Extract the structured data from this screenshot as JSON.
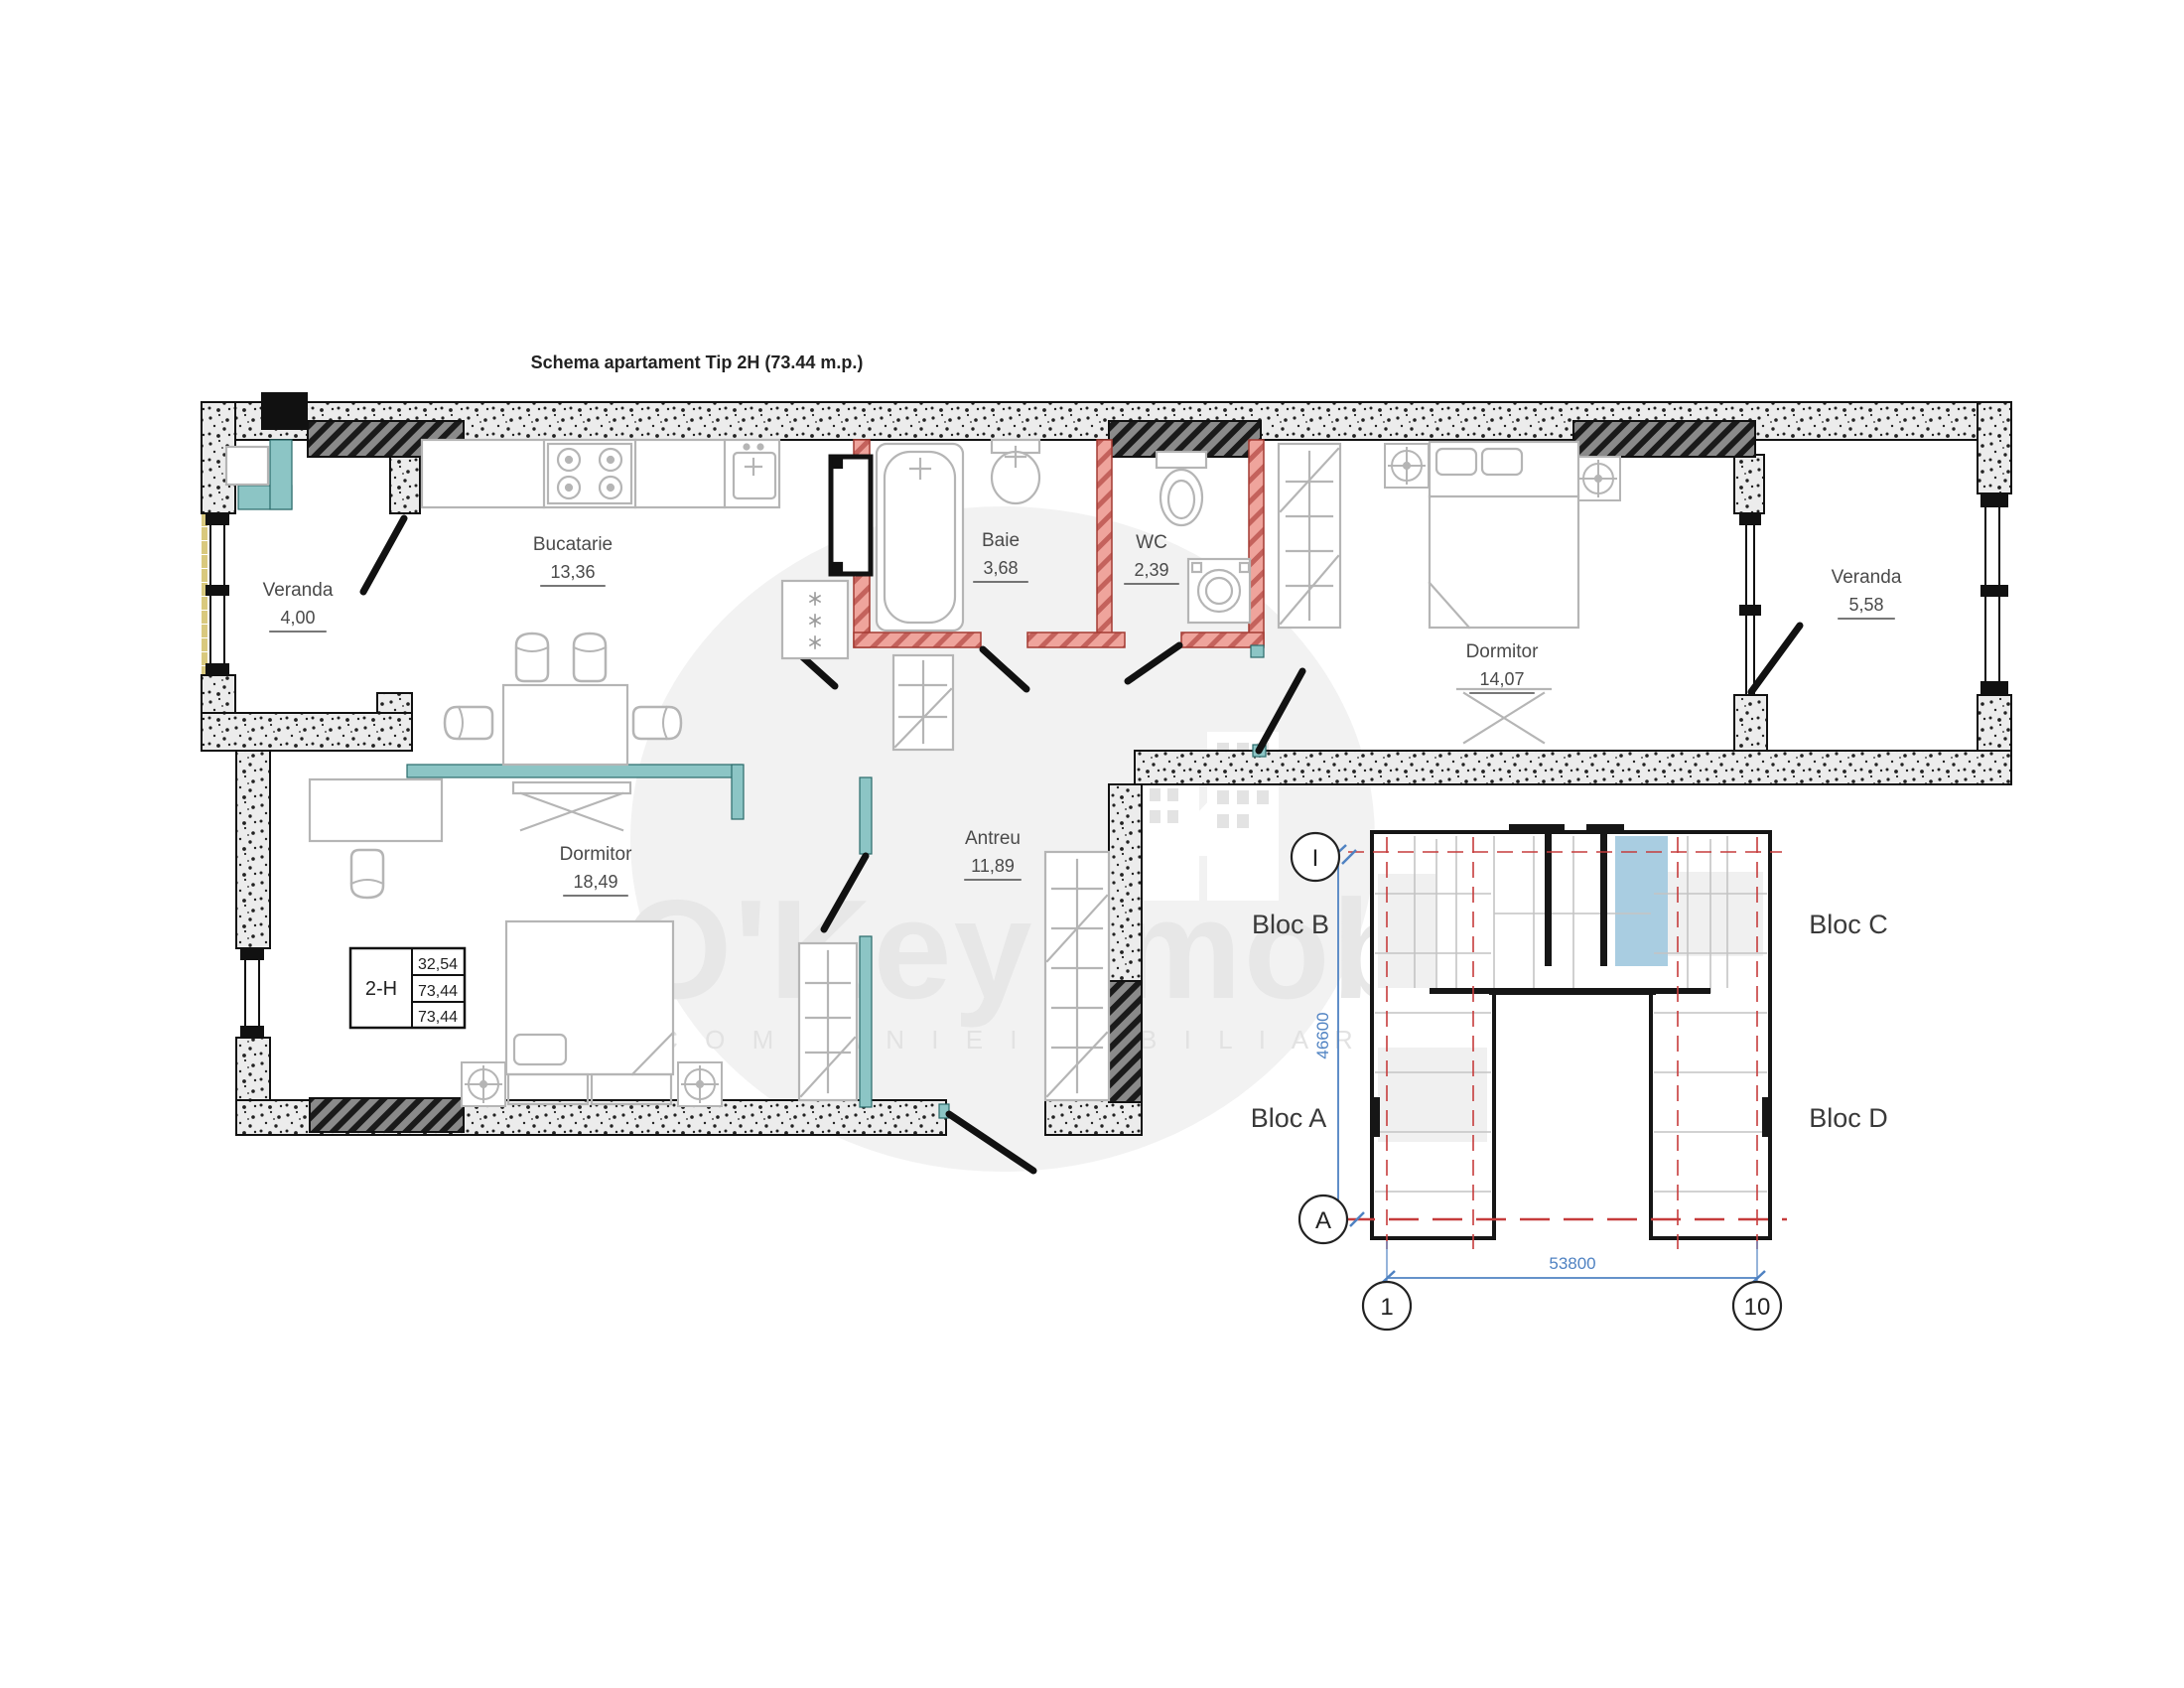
{
  "title": "Schema apartament Tip 2H (73.44 m.p.)",
  "apartment": {
    "rooms": [
      {
        "id": "veranda-1",
        "name": "Veranda",
        "area": "4,00"
      },
      {
        "id": "bucatarie",
        "name": "Bucatarie",
        "area": "13,36"
      },
      {
        "id": "baie",
        "name": "Baie",
        "area": "3,68"
      },
      {
        "id": "wc",
        "name": "WC",
        "area": "2,39"
      },
      {
        "id": "dormitor-1",
        "name": "Dormitor",
        "area": "14,07"
      },
      {
        "id": "veranda-2",
        "name": "Veranda",
        "area": "5,58"
      },
      {
        "id": "dormitor-2",
        "name": "Dormitor",
        "area": "18,49"
      },
      {
        "id": "antreu",
        "name": "Antreu",
        "area": "11,89"
      }
    ],
    "info_table": {
      "unit": "2-H",
      "values": [
        "32,54",
        "73,44",
        "73,44"
      ]
    }
  },
  "site_plan": {
    "blocks": [
      {
        "label": "Bloc B"
      },
      {
        "label": "Bloc C"
      },
      {
        "label": "Bloc A"
      },
      {
        "label": "Bloc D"
      }
    ],
    "axes": {
      "top_left": "I",
      "bottom_left": "A",
      "bottom_start": "1",
      "bottom_end": "10"
    },
    "dimensions": {
      "height": "46600",
      "width": "53800"
    }
  },
  "watermark": {
    "brand": "O'Key Imobil",
    "tagline": "C O M P A N I E   I M O B I L I A R A"
  },
  "colors": {
    "wall_speckle_bg": "#ececec",
    "hatch_dark": "#1a1a1a",
    "bath_wall_pink": "#efa49c",
    "partition_teal": "#8cc5c5",
    "axis_red": "#c63c3c",
    "dimension_blue": "#4f82c2",
    "highlight_blue": "#a9cde1",
    "furniture_gray": "#b5b5b5",
    "insulation_yellow": "#d9c97e"
  }
}
